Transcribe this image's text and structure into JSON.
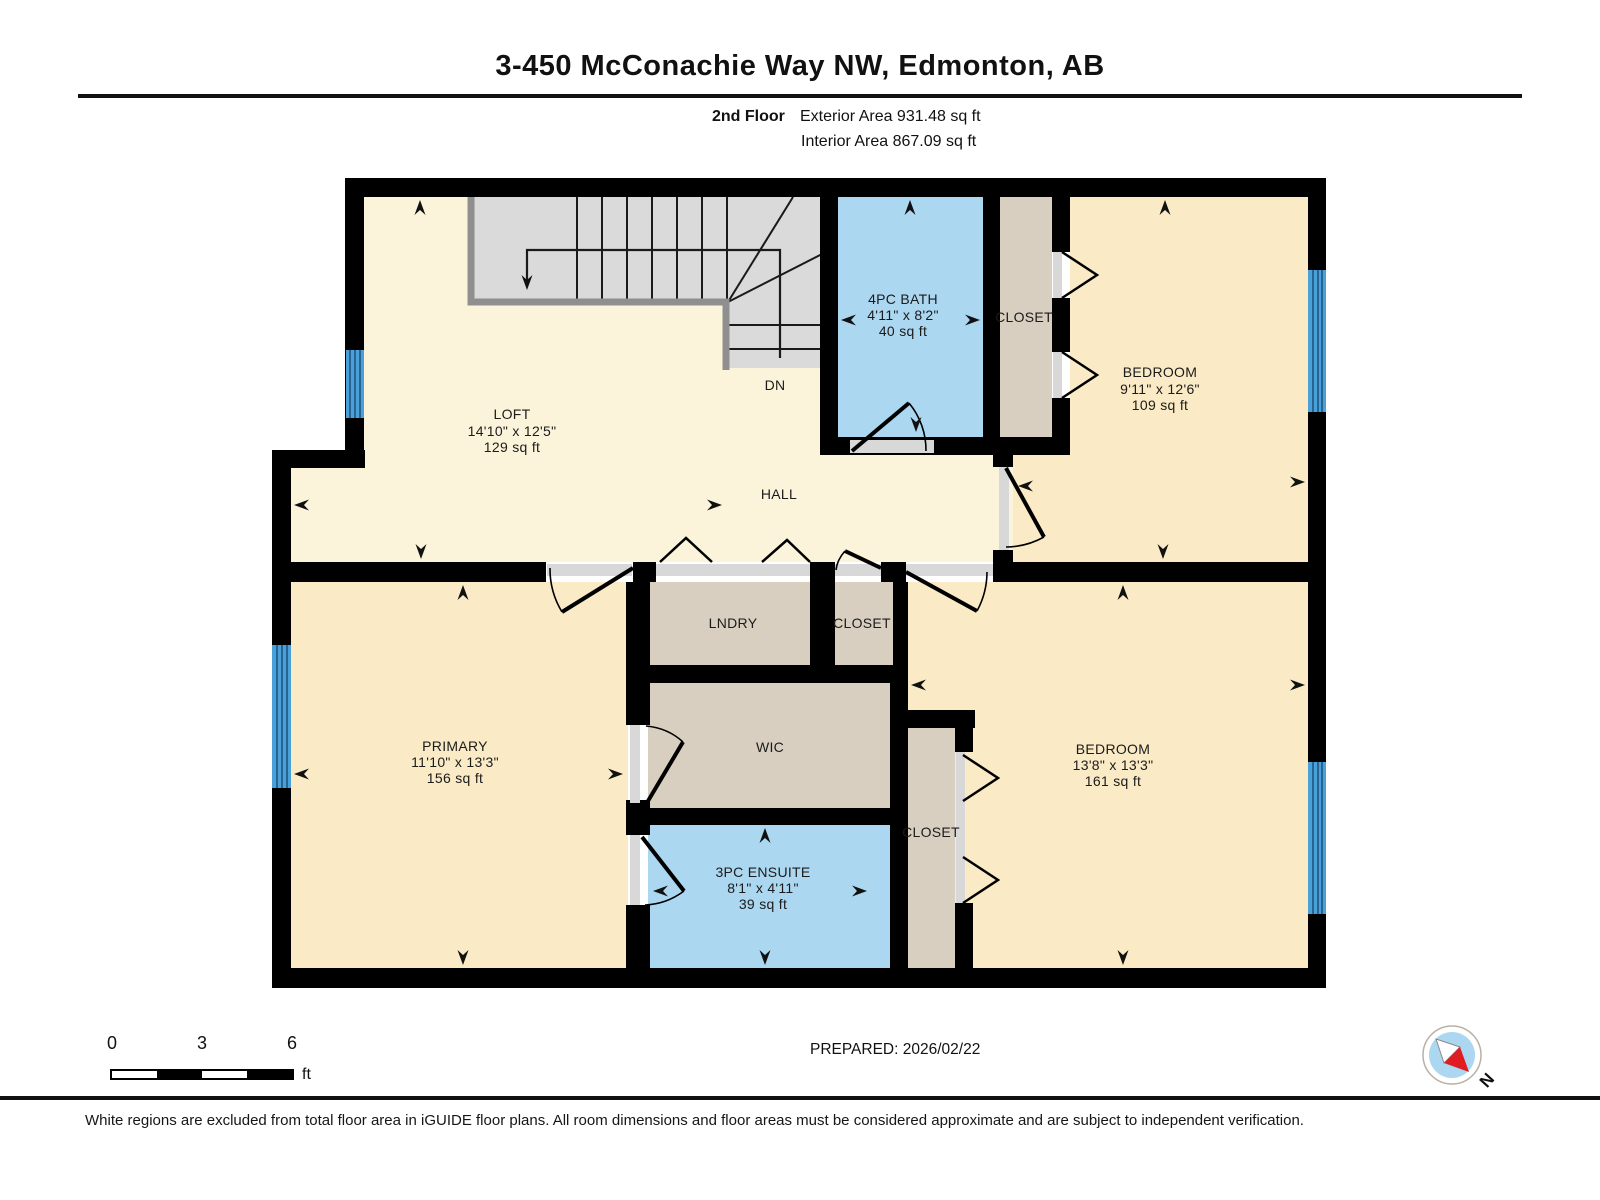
{
  "header": {
    "title": "3-450 McConachie Way NW, Edmonton, AB",
    "floor_label": "2nd Floor",
    "exterior_area": "Exterior Area 931.48 sq ft",
    "interior_area": "Interior Area 867.09 sq ft"
  },
  "plan": {
    "rooms": {
      "loft": {
        "name": "LOFT",
        "dims": "14'10\" x 12'5\"",
        "area": "129 sq ft"
      },
      "bath": {
        "name": "4PC BATH",
        "dims": "4'11\" x 8'2\"",
        "area": "40 sq ft"
      },
      "closet_top": {
        "name": "CLOSET"
      },
      "bedroom1": {
        "name": "BEDROOM",
        "dims": "9'11\" x 12'6\"",
        "area": "109 sq ft"
      },
      "hall": {
        "name": "HALL"
      },
      "stairs_label": "DN",
      "laundry": {
        "name": "LNDRY"
      },
      "closet_hall": {
        "name": "CLOSET"
      },
      "primary": {
        "name": "PRIMARY",
        "dims": "11'10\" x 13'3\"",
        "area": "156 sq ft"
      },
      "wic": {
        "name": "WIC"
      },
      "ensuite": {
        "name": "3PC ENSUITE",
        "dims": "8'1\" x 4'11\"",
        "area": "39 sq ft"
      },
      "closet_bedroom2": {
        "name": "CLOSET"
      },
      "bedroom2": {
        "name": "BEDROOM",
        "dims": "13'8\" x 13'3\"",
        "area": "161 sq ft"
      }
    },
    "colors": {
      "wall": "#000000",
      "included_floor": "#FCF4DA",
      "room_floor": "#FAEBC6",
      "wet_room": "#ABD7F0",
      "closet": "#D8CFC1",
      "stairs": "#DADADA",
      "window": "#4AA0D8",
      "excluded": "#FFFFFF",
      "compass_red": "#E11B22"
    }
  },
  "scale_bar": {
    "tick0": "0",
    "tick3": "3",
    "tick6": "6",
    "unit": "ft"
  },
  "prepared": "PREPARED: 2026/02/22",
  "compass": {
    "north_label": "N"
  },
  "footer": {
    "note": "White regions are excluded from total floor area in iGUIDE floor plans. All room dimensions and floor areas must be considered approximate and are subject to independent verification."
  }
}
